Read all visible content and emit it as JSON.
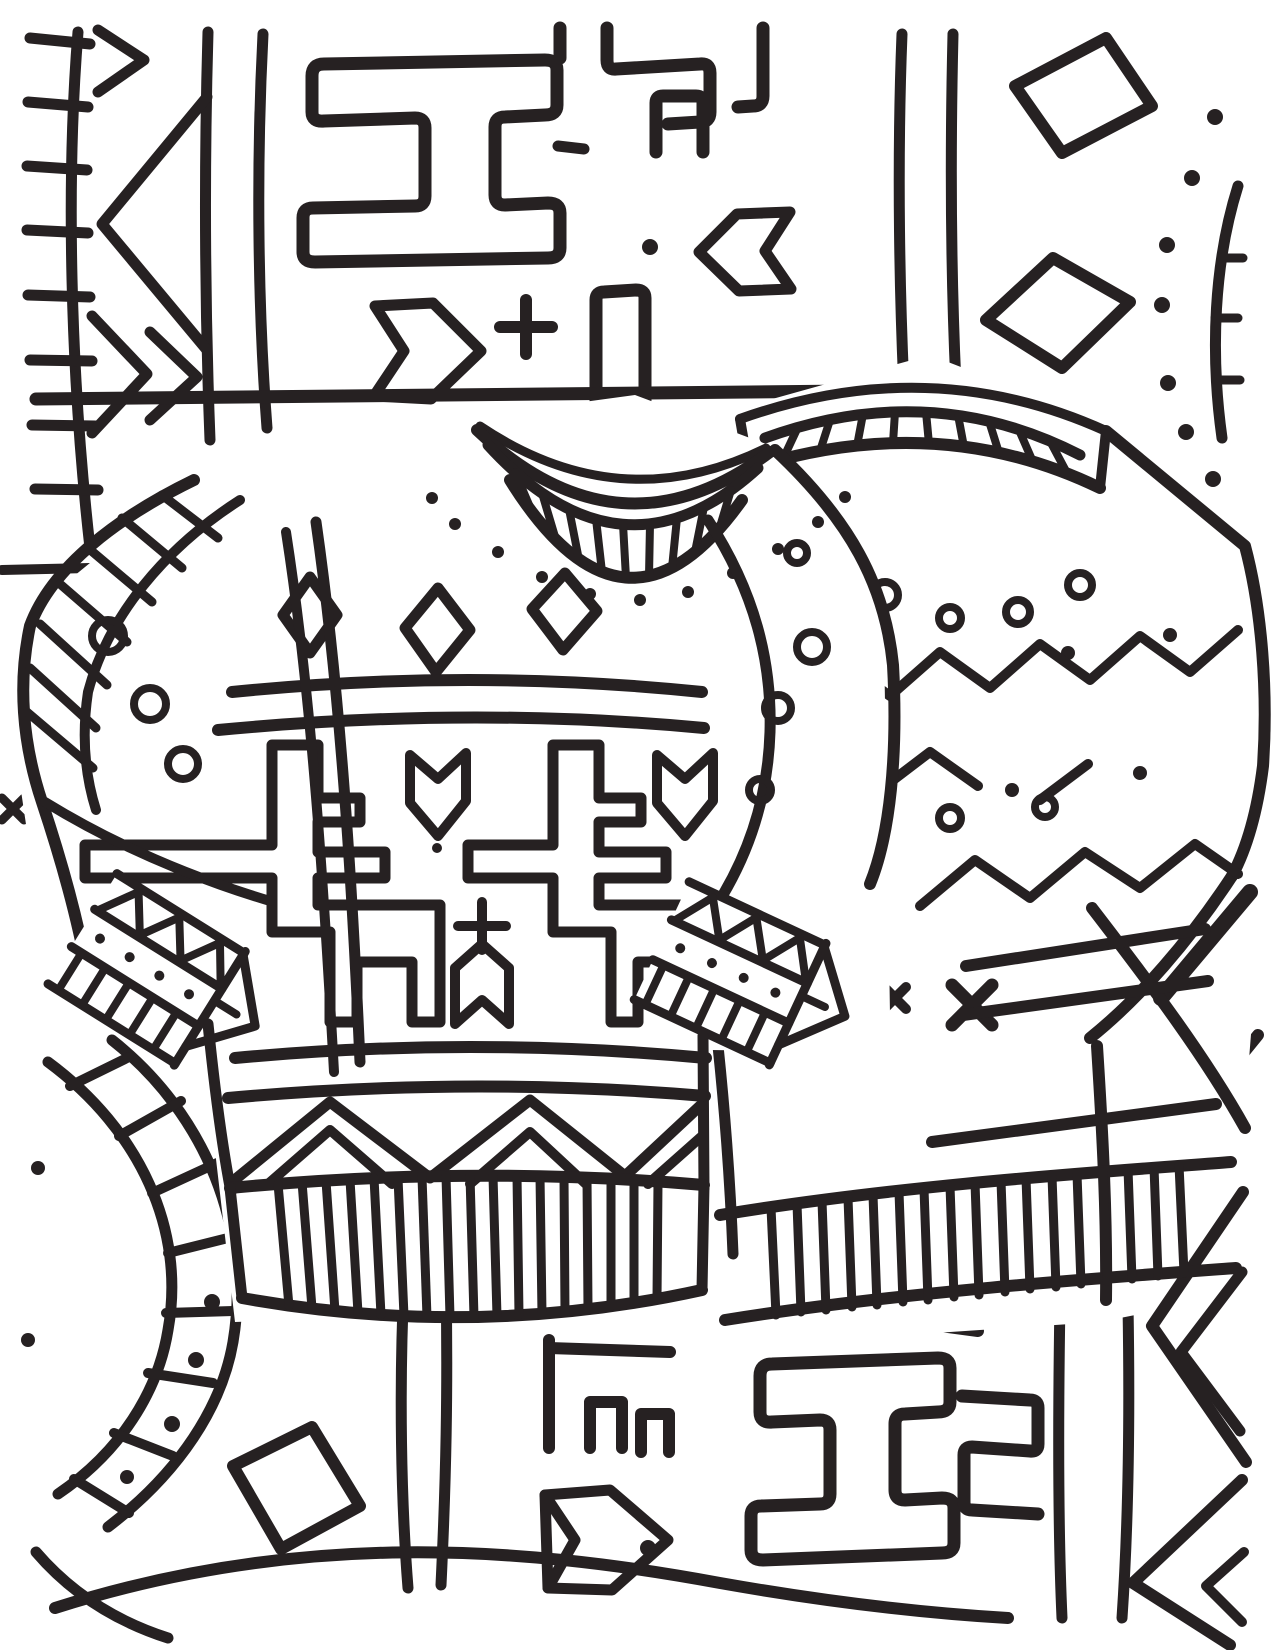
{
  "document": {
    "type": "coloring-page",
    "alt": "Black and white line-art coloring page: two patterned holiday sweaters overlapping on an African mudcloth style doodle background",
    "subject": "Patterned sweaters coloring page"
  },
  "palette": {
    "ink": "#262122",
    "paper": "#ffffff"
  },
  "scene": {
    "foreground": [
      {
        "name": "left-sweater",
        "features": [
          "ribbed crew collar",
          "dotted yoke",
          "three diamonds",
          "two geometric reindeer motifs",
          "plus sign",
          "chevron pennants",
          "zigzag band",
          "ribbed hem",
          "striped raglan sleeve",
          "ribbed cuffs with triangles and dots",
          "rings on sleeves"
        ]
      },
      {
        "name": "right-sweater",
        "features": [
          "ribbed crew collar",
          "ring and dot row",
          "zigzag rows",
          "x marks",
          "waist bands",
          "ribbed hem",
          "folded sleeve with strap"
        ]
      }
    ],
    "background": [
      "ladder stripe border",
      "nested triangle",
      "maze key pattern",
      "chevron arrows",
      "plus signs",
      "tilted squares",
      "dot clusters",
      "vertical lines",
      "concentric ladder arc",
      "nested chevrons",
      "bottom hill arc"
    ]
  }
}
